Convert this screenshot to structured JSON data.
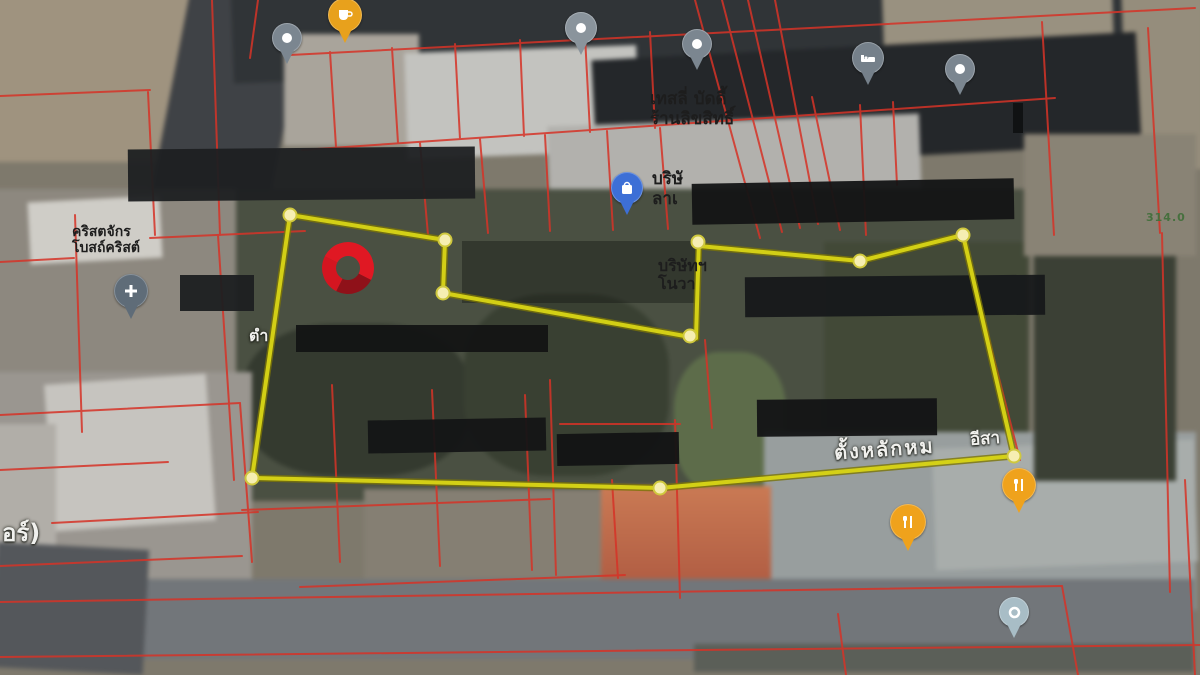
{
  "map": {
    "view": "satellite",
    "labels": {
      "store_line1": "เทสลี่ บัดดี้",
      "store_line2": "ร้านลิขสิทธิ์",
      "company_top_line1": "บริษั",
      "company_top_line2": "ลาเ",
      "company_mid_line1": "บริษัทฯ",
      "company_mid_line2": "โนวา",
      "church_line1": "คริสตจักร",
      "church_line2": "โบสถ์คริสต์",
      "tam": "ตำ",
      "or_fragment": "อร์)",
      "tang_lak": "ตั้งหลักหม",
      "eesa": "อีสา",
      "green_number": "314.0"
    },
    "pins": [
      {
        "name": "coffee-pin",
        "icon": "coffee",
        "color": "#e8a11c",
        "x": 345,
        "y": 15,
        "s": 34
      },
      {
        "name": "gray-pin-1",
        "icon": "dot",
        "color": "#7b8690",
        "x": 287,
        "y": 38,
        "s": 30
      },
      {
        "name": "gray-pin-2",
        "icon": "dot",
        "color": "#8a949c",
        "x": 581,
        "y": 28,
        "s": 32
      },
      {
        "name": "gray-pin-3",
        "icon": "dot",
        "color": "#7b8690",
        "x": 697,
        "y": 44,
        "s": 30
      },
      {
        "name": "hotel-pin",
        "icon": "bed",
        "color": "#75808a",
        "x": 868,
        "y": 58,
        "s": 32
      },
      {
        "name": "gray-pin-4",
        "icon": "dot",
        "color": "#7b8690",
        "x": 960,
        "y": 69,
        "s": 30
      },
      {
        "name": "shopping-pin",
        "icon": "bag",
        "color": "#3d6fd6",
        "x": 627,
        "y": 188,
        "s": 32
      },
      {
        "name": "church-pin",
        "icon": "cross",
        "color": "#5f6c78",
        "x": 131,
        "y": 291,
        "s": 34
      },
      {
        "name": "restaurant-pin-1",
        "icon": "fork",
        "color": "#efa21c",
        "x": 908,
        "y": 522,
        "s": 36
      },
      {
        "name": "restaurant-pin-2",
        "icon": "fork",
        "color": "#efa21c",
        "x": 1019,
        "y": 485,
        "s": 34
      },
      {
        "name": "teal-pin",
        "icon": "ring",
        "color": "#a8bdc6",
        "x": 1014,
        "y": 612,
        "s": 30
      }
    ],
    "parcel_outline": {
      "stroke": "#d8d516",
      "under_stroke": "#7a7408",
      "dot_fill": "#f6eeb2",
      "segments": [
        [
          [
            290,
            215
          ],
          [
            445,
            240
          ]
        ],
        [
          [
            445,
            240
          ],
          [
            443,
            293
          ]
        ],
        [
          [
            443,
            293
          ],
          [
            696,
            338
          ]
        ],
        [
          [
            699,
            238
          ],
          [
            696,
            338
          ]
        ],
        [
          [
            699,
            246
          ],
          [
            860,
            261
          ]
        ],
        [
          [
            860,
            261
          ],
          [
            963,
            235
          ]
        ],
        [
          [
            963,
            235
          ],
          [
            1014,
            456
          ]
        ],
        [
          [
            1014,
            456
          ],
          [
            660,
            488
          ]
        ],
        [
          [
            660,
            488
          ],
          [
            252,
            478
          ]
        ],
        [
          [
            252,
            478
          ],
          [
            290,
            215
          ]
        ]
      ],
      "vertex_dots": [
        [
          290,
          215
        ],
        [
          445,
          240
        ],
        [
          443,
          293
        ],
        [
          690,
          336
        ],
        [
          698,
          242
        ],
        [
          860,
          261
        ],
        [
          963,
          235
        ],
        [
          1014,
          456
        ],
        [
          660,
          488
        ],
        [
          252,
          478
        ]
      ]
    },
    "red_marker": {
      "name": "selected-location-ring",
      "color": "#e01823"
    },
    "cadastral_color": "#d63327"
  }
}
